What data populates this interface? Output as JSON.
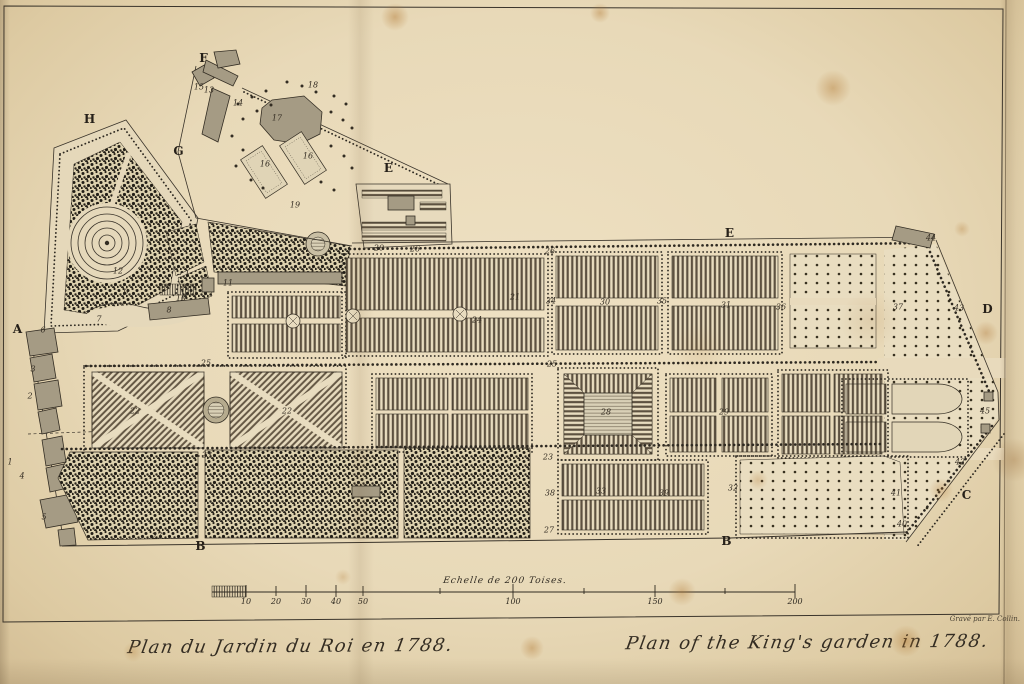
{
  "plate": {
    "title_french": "Plan du Jardin du Roi en 1788.",
    "title_english": "Plan of the King's garden in 1788.",
    "engraver_credit": "Gravé par E. Collin.",
    "year": "1788"
  },
  "colors": {
    "paper": "#e8dabb",
    "ink": "#2f2a21",
    "building_fill": "#a59b84",
    "foxing": "#b07630"
  },
  "scale_bar": {
    "label": "Echelle de 200 Toises.",
    "unit": "Toises",
    "max_value": "200",
    "tick_labels": [
      {
        "text": "10",
        "x": 246,
        "y": 597
      },
      {
        "text": "20",
        "x": 276,
        "y": 597
      },
      {
        "text": "30",
        "x": 306,
        "y": 597
      },
      {
        "text": "40",
        "x": 336,
        "y": 597
      },
      {
        "text": "50",
        "x": 363,
        "y": 597
      },
      {
        "text": "100",
        "x": 513,
        "y": 597
      },
      {
        "text": "150",
        "x": 655,
        "y": 597
      },
      {
        "text": "200",
        "x": 795,
        "y": 597
      }
    ]
  },
  "plan": {
    "letter_labels": [
      {
        "text": "A",
        "x": 18,
        "y": 329
      },
      {
        "text": "B",
        "x": 201,
        "y": 546
      },
      {
        "text": "B",
        "x": 727,
        "y": 541
      },
      {
        "text": "C",
        "x": 967,
        "y": 495
      },
      {
        "text": "D",
        "x": 988,
        "y": 309
      },
      {
        "text": "E",
        "x": 389,
        "y": 168
      },
      {
        "text": "E",
        "x": 730,
        "y": 233
      },
      {
        "text": "F",
        "x": 204,
        "y": 58
      },
      {
        "text": "G",
        "x": 179,
        "y": 151
      },
      {
        "text": "H",
        "x": 90,
        "y": 119
      }
    ],
    "number_labels": [
      {
        "text": "1",
        "x": 10,
        "y": 462
      },
      {
        "text": "2",
        "x": 30,
        "y": 396
      },
      {
        "text": "3",
        "x": 33,
        "y": 369
      },
      {
        "text": "4",
        "x": 22,
        "y": 476
      },
      {
        "text": "5",
        "x": 44,
        "y": 517
      },
      {
        "text": "6",
        "x": 43,
        "y": 330
      },
      {
        "text": "7",
        "x": 99,
        "y": 319
      },
      {
        "text": "8",
        "x": 169,
        "y": 310
      },
      {
        "text": "9",
        "x": 126,
        "y": 292
      },
      {
        "text": "10",
        "x": 181,
        "y": 298
      },
      {
        "text": "11",
        "x": 228,
        "y": 283
      },
      {
        "text": "12",
        "x": 118,
        "y": 271
      },
      {
        "text": "13",
        "x": 209,
        "y": 90
      },
      {
        "text": "14",
        "x": 238,
        "y": 103
      },
      {
        "text": "15",
        "x": 199,
        "y": 87
      },
      {
        "text": "16",
        "x": 265,
        "y": 164
      },
      {
        "text": "16",
        "x": 308,
        "y": 156
      },
      {
        "text": "17",
        "x": 277,
        "y": 118
      },
      {
        "text": "18",
        "x": 313,
        "y": 85
      },
      {
        "text": "19",
        "x": 295,
        "y": 205
      },
      {
        "text": "20",
        "x": 379,
        "y": 248
      },
      {
        "text": "21",
        "x": 515,
        "y": 297
      },
      {
        "text": "22",
        "x": 135,
        "y": 411
      },
      {
        "text": "22",
        "x": 287,
        "y": 411
      },
      {
        "text": "23",
        "x": 207,
        "y": 455
      },
      {
        "text": "23",
        "x": 548,
        "y": 457
      },
      {
        "text": "24",
        "x": 477,
        "y": 320
      },
      {
        "text": "25",
        "x": 206,
        "y": 363
      },
      {
        "text": "25",
        "x": 552,
        "y": 364
      },
      {
        "text": "26",
        "x": 415,
        "y": 249
      },
      {
        "text": "26",
        "x": 550,
        "y": 251
      },
      {
        "text": "27",
        "x": 157,
        "y": 536
      },
      {
        "text": "27",
        "x": 549,
        "y": 530
      },
      {
        "text": "28",
        "x": 606,
        "y": 412
      },
      {
        "text": "29",
        "x": 724,
        "y": 412
      },
      {
        "text": "30",
        "x": 605,
        "y": 302
      },
      {
        "text": "31",
        "x": 726,
        "y": 305
      },
      {
        "text": "32",
        "x": 733,
        "y": 488
      },
      {
        "text": "33",
        "x": 601,
        "y": 491
      },
      {
        "text": "34",
        "x": 551,
        "y": 301
      },
      {
        "text": "35",
        "x": 662,
        "y": 301
      },
      {
        "text": "36",
        "x": 781,
        "y": 307
      },
      {
        "text": "37",
        "x": 898,
        "y": 307
      },
      {
        "text": "38",
        "x": 550,
        "y": 493
      },
      {
        "text": "39",
        "x": 664,
        "y": 493
      },
      {
        "text": "40",
        "x": 902,
        "y": 524
      },
      {
        "text": "41",
        "x": 896,
        "y": 493
      },
      {
        "text": "42",
        "x": 960,
        "y": 462
      },
      {
        "text": "43",
        "x": 959,
        "y": 308
      },
      {
        "text": "44",
        "x": 931,
        "y": 238
      },
      {
        "text": "45",
        "x": 985,
        "y": 411
      }
    ]
  }
}
